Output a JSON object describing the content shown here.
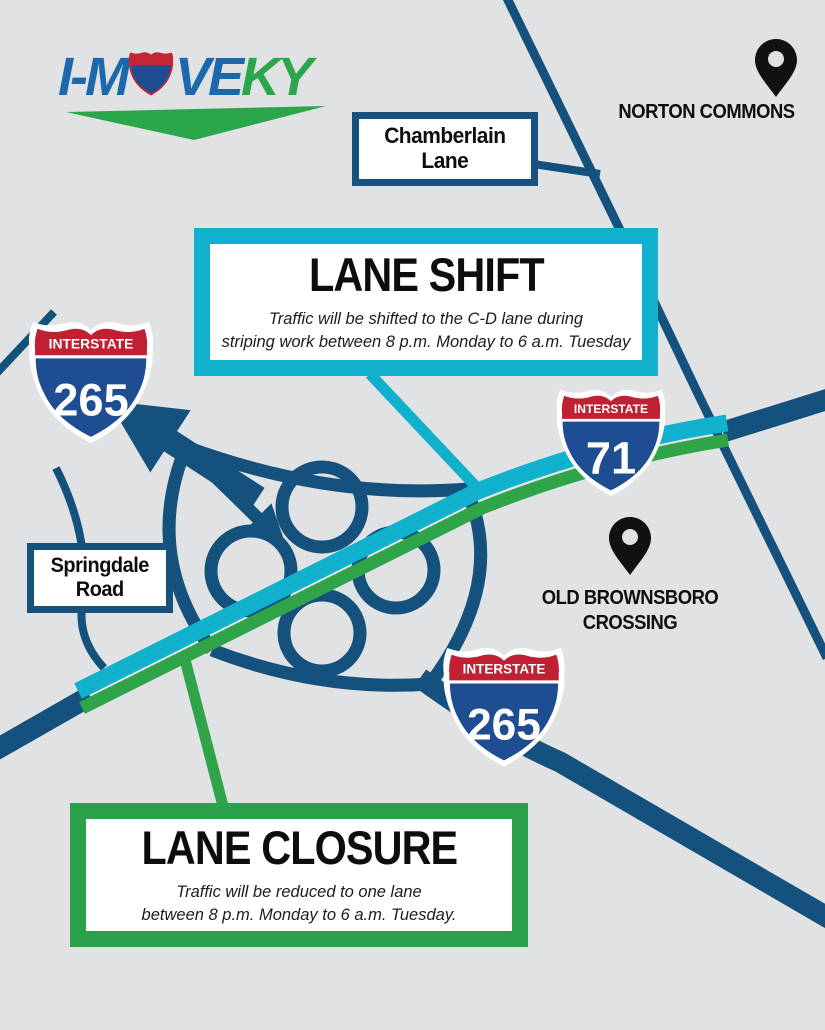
{
  "logo": {
    "part_i": "I-M",
    "part_ve": "VE",
    "part_ky": "KY"
  },
  "locations": {
    "norton": {
      "label": "NORTON COMMONS"
    },
    "brownsboro": {
      "line1": "OLD BROWNSBORO",
      "line2": "CROSSING"
    }
  },
  "road_boxes": {
    "chamberlain": {
      "line1": "Chamberlain",
      "line2": "Lane"
    },
    "springdale": {
      "line1": "Springdale",
      "line2": "Road"
    }
  },
  "shields": [
    {
      "top": "INTERSTATE",
      "number": "265"
    },
    {
      "top": "INTERSTATE",
      "number": "71"
    },
    {
      "top": "INTERSTATE",
      "number": "265"
    }
  ],
  "banners": {
    "lane_shift": {
      "title": "LANE SHIFT",
      "description_line1": "Traffic will be shifted to the C-D lane during",
      "description_line2": "striping work between 8 p.m. Monday to 6 a.m. Tuesday"
    },
    "lane_closure": {
      "title": "LANE CLOSURE",
      "description_line1": "Traffic will be reduced to one lane",
      "description_line2": "between 8 p.m. Monday to 6 a.m. Tuesday."
    }
  },
  "colors": {
    "background": "#e1e2e4",
    "road_blue": "#15517d",
    "highlight_teal": "#10b1cc",
    "highlight_green": "#2fa449",
    "box_border_blue": "#17517e",
    "shield_red": "#bf2132",
    "shield_blue": "#1f4d92",
    "logo_blue": "#1b69ac",
    "logo_green": "#2ca64a",
    "pin_black": "#111111"
  }
}
